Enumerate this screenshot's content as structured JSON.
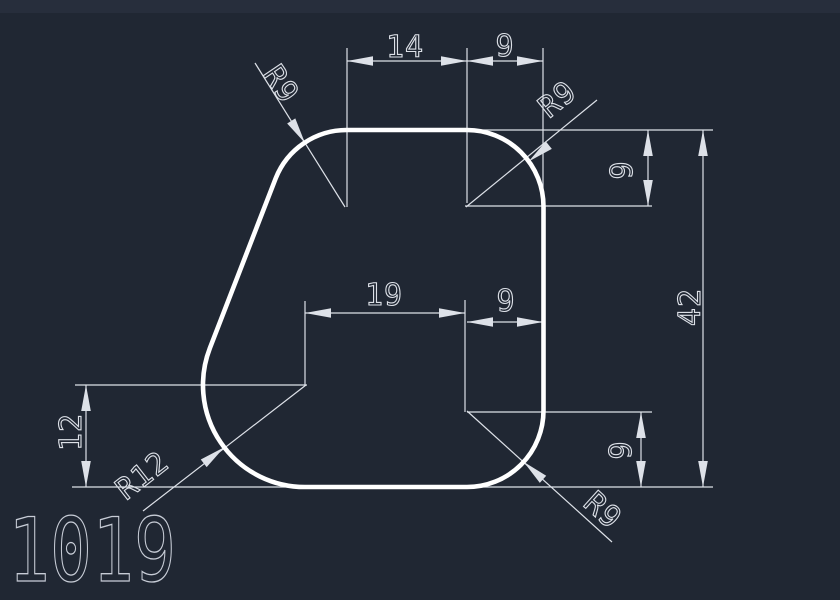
{
  "colors": {
    "background": "#202733",
    "background_top": "#272e3c",
    "outline": "#ffffff",
    "dimension": "#dde1e8",
    "label": "#c7ccd6"
  },
  "drawing_number": "1019",
  "dim_labels": {
    "top_width": "14",
    "top_corner_width": "9",
    "top_corner_height": "9",
    "overall_height": "42",
    "bottom_width": "19",
    "bottom_corner_width": "9",
    "left_height": "12",
    "bottom_corner_height": "9"
  },
  "radius_labels": {
    "top_left": "R9",
    "top_right": "R9",
    "bottom_right": "R9",
    "bottom_left": "R12"
  }
}
